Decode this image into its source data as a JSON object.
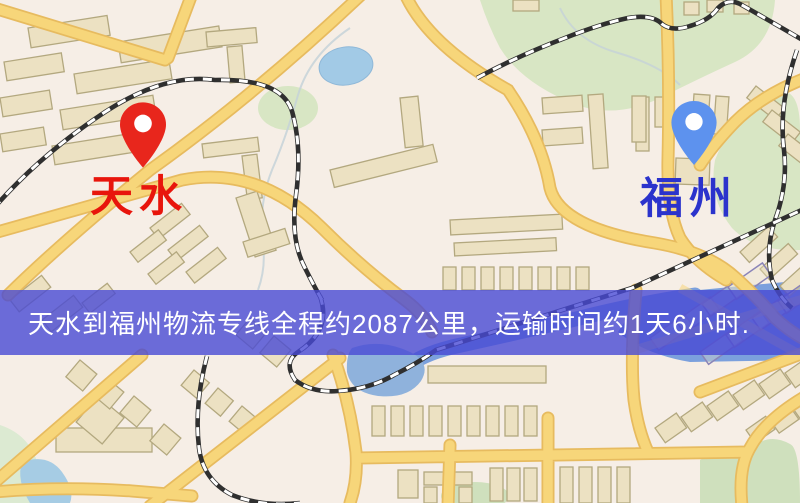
{
  "banner": {
    "text": "天水到福州物流专线全程约2087公里，运输时间约1天6小时."
  },
  "markers": {
    "origin": {
      "name": "天水"
    },
    "destination": {
      "name": "福州"
    }
  },
  "route": {
    "distance_text": "约2087公里",
    "duration_text": "约1天6小时"
  },
  "colors": {
    "map-bg": "#f6eee6",
    "banner-bg": "rgba(72,74,212,0.8)",
    "banner-text": "#ffffff",
    "origin-label": "#e8150c",
    "destination-label": "#2b33cc",
    "origin-pin": "#e8261c",
    "destination-pin": "#5d92ee"
  }
}
